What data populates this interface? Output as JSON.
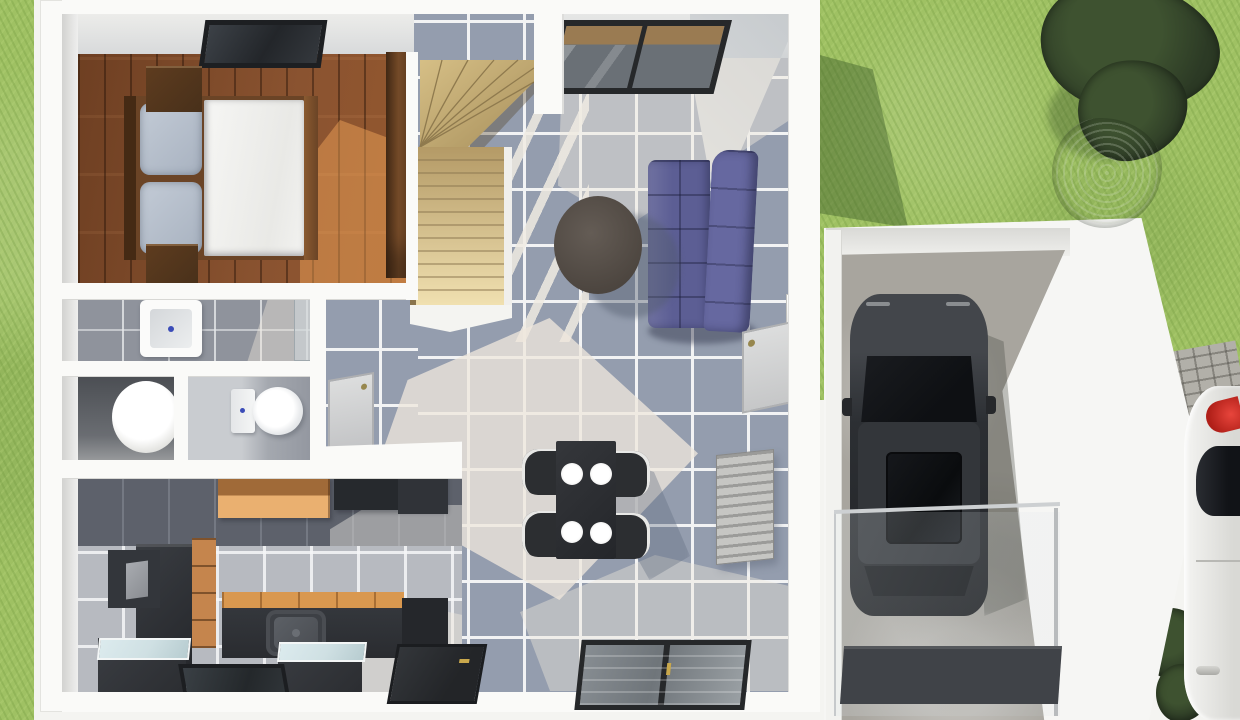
{
  "scene": {
    "type": "3d-floor-plan-render",
    "view": "top-down isometric",
    "subject": "single-storey house ground floor with attached garage, lawn and parked cars"
  },
  "palette": {
    "grass": "#9fc163",
    "grass_dark": "#7fa64e",
    "grass_shadow": "#55803c",
    "tree_dark": "#2c3a25",
    "tree_mid": "#3e5230",
    "tree_gray": "#6c7a5e",
    "wall_white": "#fafaf8",
    "wall_face": "#cdd0d3",
    "tile_floor": "#949dae",
    "grout": "#f2f3f4",
    "wood_floor": "#7c4827",
    "stair_light": "#eedfae",
    "stair_mid": "#c9b177",
    "sofa_seat": "#5c5e94",
    "sofa_back": "#6668a0",
    "coffee_table": "#564f49",
    "dining_dark": "#2c2e31",
    "plate": "#f1f1ef",
    "radiator": "#bdbdbb",
    "bath_tile": "#8f939c",
    "fixture_white": "#fbfbfa",
    "accent_blue": "#3b4cb8",
    "kitchen_wood": "#c5854d",
    "unit_dark": "#303338",
    "backsplash": "#5d616b",
    "kitchen_floor": "#b7bac0",
    "appliance_glass": "#cfe0e3",
    "concrete": "#a8a59e",
    "car_dark": "#2e3135",
    "car_glass": "#121417",
    "white_car": "#eeeeec",
    "taillight_red": "#ce2b24",
    "paver": "#b2b0a9",
    "floor_mat": "#404348",
    "window_frame": "#26282a"
  },
  "house": {
    "rooms": [
      {
        "name": "bedroom",
        "floor": "hardwood planks",
        "furniture": [
          "double-bed with white duvet and two gray pillows",
          "wood headboard",
          "nightstand x2",
          "tall wardrobe",
          "ceiling skylight window"
        ]
      },
      {
        "name": "staircase",
        "style": "L-shaped winder stair, light wood treads"
      },
      {
        "name": "living-dining-room",
        "floor": "blue-gray tile with sunlight patches",
        "furniture": [
          "purple two-seat sofa",
          "round dark coffee table",
          "black dining table with four white plates",
          "four black chairs",
          "wall radiator",
          "sliding glass window (top wall)",
          "double window (front wall)",
          "front entry door",
          "wall niche",
          "interior door leaf"
        ]
      },
      {
        "name": "bathroom",
        "furniture": [
          "square washbasin with blue drain",
          "glass shower screen"
        ]
      },
      {
        "name": "utility-room",
        "furniture": [
          "round white tub"
        ]
      },
      {
        "name": "wc",
        "furniture": [
          "toilet with cistern"
        ]
      },
      {
        "name": "hallway",
        "furniture": [
          "interior door"
        ]
      },
      {
        "name": "kitchen",
        "furniture": [
          "wood wall cabinets",
          "dark wall cabinet",
          "refrigerator",
          "wood drawer unit",
          "dark counter with sink",
          "wood countertop section",
          "glass-top appliance x2",
          "front floor window"
        ]
      }
    ]
  },
  "garage": {
    "walls": "white angled wall",
    "floor": "concrete",
    "contents": [
      "dark SUV seen from above with sunroof",
      "glass railing",
      "dark floor mat"
    ]
  },
  "exterior": {
    "lawn": "green grass left strip and backyard",
    "trees": [
      "dark green tree",
      "olive shrub"
    ],
    "walkway": "stone pavers",
    "parked_car": {
      "color": "white",
      "visible_details": [
        "red taillight",
        "dark rear window",
        "door handle"
      ]
    },
    "shadows": [
      "house shadow on grass",
      "furniture shadows on tile"
    ]
  }
}
